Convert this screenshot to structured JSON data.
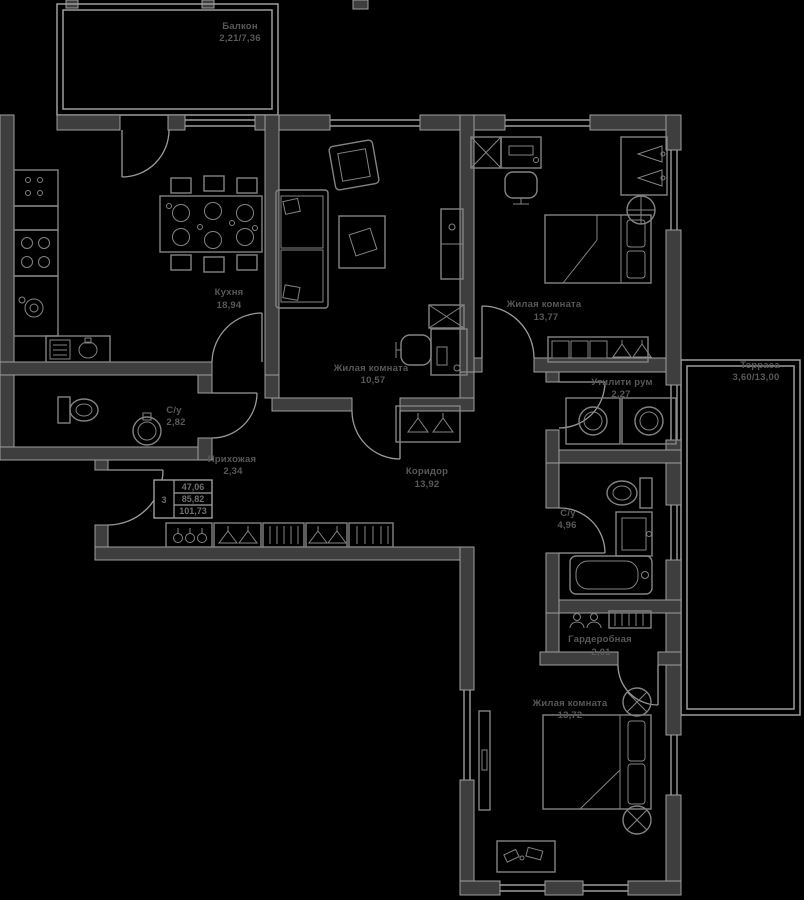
{
  "rooms": {
    "balcony": {
      "name": "Балкон",
      "area": "2,21/7,36"
    },
    "kitchen": {
      "name": "Кухня",
      "area": "18,94"
    },
    "living_room": {
      "name": "Жилая комната",
      "area": "10,57"
    },
    "bedroom_top": {
      "name": "Жилая комната",
      "area": "13,77"
    },
    "terrace": {
      "name": "Терраса",
      "area": "3,60/13,00"
    },
    "utility": {
      "name": "Утилити рум",
      "area": "2,27"
    },
    "bathroom_small": {
      "name": "С/у",
      "area": "2,82"
    },
    "hallway": {
      "name": "Прихожая",
      "area": "2,34"
    },
    "corridor": {
      "name": "Коридор",
      "area": "13,92"
    },
    "bathroom_big": {
      "name": "С/у",
      "area": "4,96"
    },
    "wardrobe": {
      "name": "Гардеробная",
      "area": "2,01"
    },
    "bedroom_bottom": {
      "name": "Жилая комната",
      "area": "13,72"
    }
  },
  "area_table": {
    "rooms_count": "3",
    "area_values": [
      "47,06",
      "85,82",
      "101,73"
    ]
  },
  "colors": {
    "background": "#000000",
    "wall_fill": "#3e3e3e",
    "line": "#9e9e9e",
    "furniture_line": "#838383",
    "label_text": "#585858"
  }
}
